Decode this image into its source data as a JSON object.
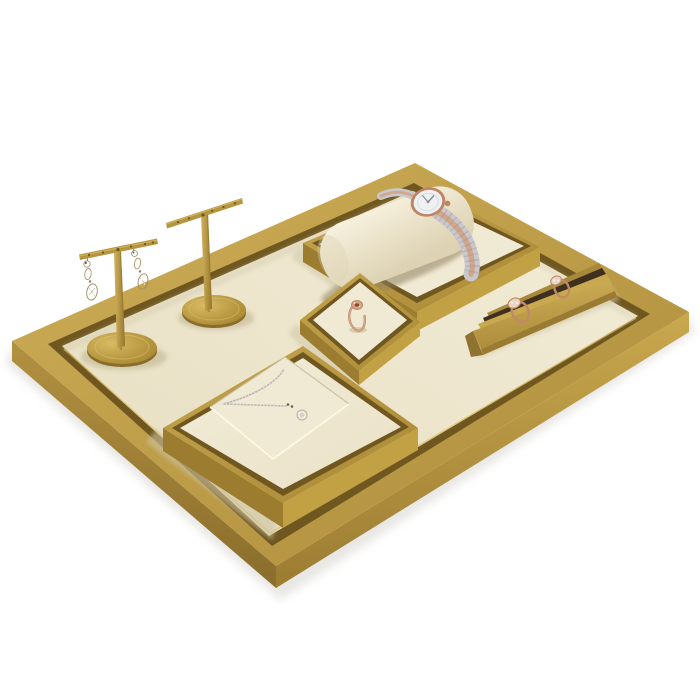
{
  "scene": {
    "type": "product-photograph",
    "subject": "Brass jewelry display tray set with ivory leather inserts holding earrings, a watch, rings and a pendant necklace",
    "objects": [
      {
        "name": "display-tray",
        "label": "rectangular brushed-brass tray with ivory leather floor"
      },
      {
        "name": "earring-stand-left",
        "label": "brass T-bar stand with two champagne crystal drop earrings"
      },
      {
        "name": "earring-stand-right",
        "label": "brass T-bar earring stand, empty"
      },
      {
        "name": "watch-display",
        "label": "brass-framed riser with ivory pillow and two-tone rose-gold watch"
      },
      {
        "name": "ring-display",
        "label": "small brass-framed riser with rose-gold gemstone ring"
      },
      {
        "name": "necklace-display",
        "label": "brass-framed pad with silver halo-pendant necklace"
      },
      {
        "name": "ring-bar",
        "label": "brass slotted bar holding two rose-gold rings"
      }
    ]
  },
  "colors": {
    "background": "#ffffff",
    "drop_shadow": "#dcdad5",
    "gold_hi": "#cfae58",
    "gold_lo": "#ad8c3a",
    "gold_lip": "#6f571f",
    "gold_side_mid": "#b29140",
    "gold_side_dark": "#8a6d2c",
    "gold_side_light": "#c9a84e",
    "gold_side_mid2": "#9c7c32",
    "tray_inner_hi": "#d9bd6a",
    "cream_hi": "#f3edd8",
    "cream_lo": "#e7dec1",
    "cream_panel_hi": "#f2ecd8",
    "cream_panel_lo": "#eae1c6",
    "cream_flat": "#f0e9d4",
    "cream_inset": "#f0ead5",
    "inset_line_dark": "#c7bc9e",
    "inset_line_light": "#fff8e4",
    "floor_shadow": "#cdc3a2",
    "plat_side_dark": "#9c7d30",
    "plat_side_light": "#c2a145",
    "gold_frame_hi": "#c5a44d",
    "gold_frame_lo": "#aa8936",
    "pillow_hi": "#f8f2e1",
    "pillow_lo": "#ddd2b2",
    "pillow_slot": "#8f8060",
    "silver": "#c9c8cc",
    "silver_dark": "#8e8a8e",
    "rose": "#d2a384",
    "rose_case": "#c08464",
    "rose_deep": "#c08a66",
    "rose_band_hi": "#e8c4a8",
    "rose_head": "#d8a383",
    "gem_center": "#8a4a38",
    "dial": "#eef0f2",
    "dial_ring": "#d9dce0",
    "hand": "#8a8d92",
    "crystal": "#eadcba",
    "crystal_hi": "#f0e6cc",
    "crystal_line": "#a18c60",
    "crystal_dark": "#6f5d42",
    "crystal_pave": "#e9d7c5",
    "chain": "#bdb8ae",
    "chain_hi": "#efece6",
    "clasp": "#70604b",
    "pendant": "#efe8da",
    "pendant_ring": "#b7afa0",
    "pendant_core": "#d8d0c0",
    "sparkle": "#ffffff",
    "slot_dark": "#3f2f1e",
    "gold_backlip": "#a8893a",
    "gold_edge_bright": "#c9a94f",
    "gold_edge_dark": "#9a7b31",
    "gold_endcap": "#8f7230",
    "gold_bar_hi": "#d0b059",
    "gold_bar_lo": "#ad8d3a",
    "base_hi": "#d8bb63",
    "base_hi2": "#e3c976",
    "base_lo": "#a5842e",
    "base_rim": "#8a6d2c",
    "stem_hi": "#d2b35c",
    "stem_lo": "#96782e",
    "tbar": "#b5953f",
    "tbar_hi": "#d9bd6a",
    "notch": "#6d571f"
  }
}
